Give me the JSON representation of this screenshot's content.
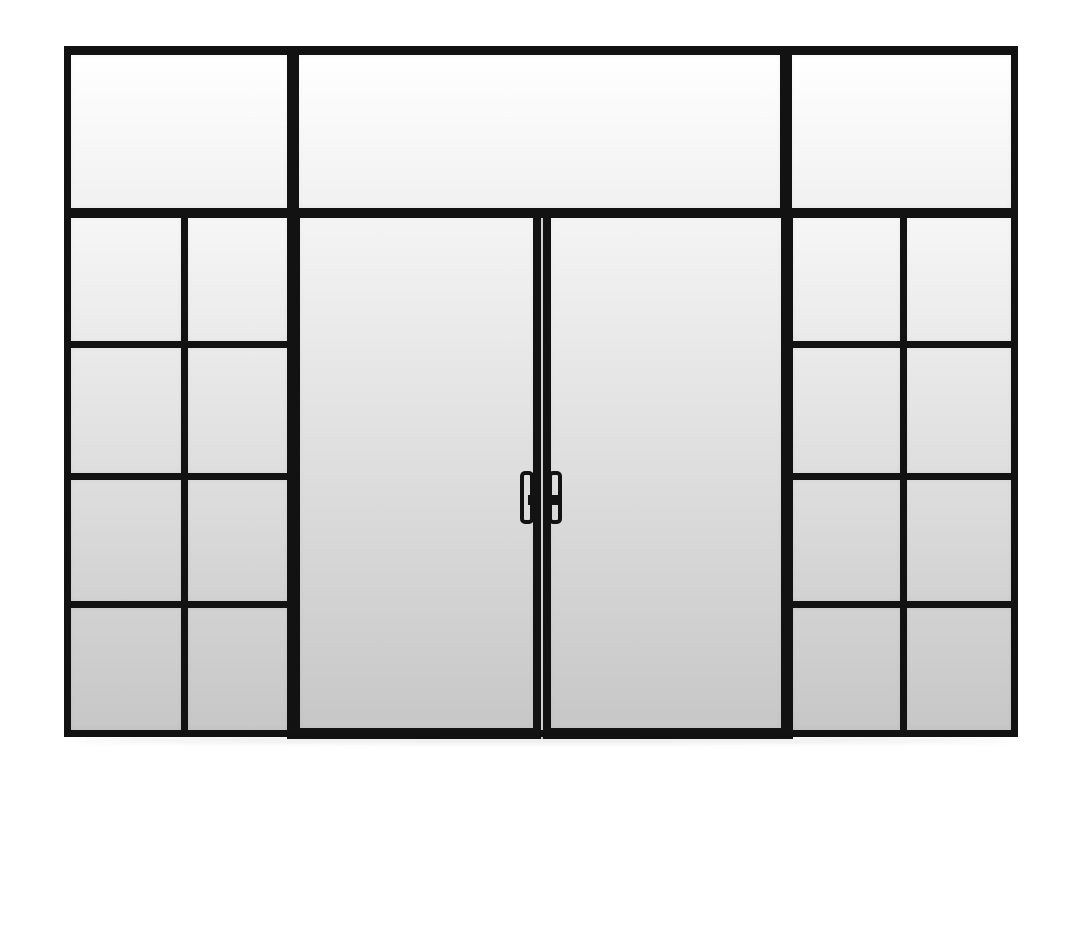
{
  "scene": {
    "description": "Black steel framed glass partition wall with double glass doors, a three-panel transom above, and two four-row grid sidelites, on a white background"
  },
  "colors": {
    "background": "#ffffff",
    "frame": "#121212",
    "meeting_gap": "#cfcfcf",
    "shadow": "rgba(0,0,0,0.09)",
    "transom_glass_gradient": [
      "#ffffff",
      "#f1f1f1"
    ],
    "door_glass_gradient": [
      "#f4f4f4",
      "#c7c7c7"
    ],
    "sidelite_row_gradients": [
      [
        "#f6f6f6",
        "#eaeaea"
      ],
      [
        "#eaeaea",
        "#dedede"
      ],
      [
        "#dedede",
        "#d2d2d2"
      ],
      [
        "#d2d2d2",
        "#c7c7c7"
      ]
    ]
  },
  "structure": {
    "transom": {
      "panels": 3
    },
    "left_sidelite": {
      "columns": 2,
      "rows": 4
    },
    "right_sidelite": {
      "columns": 2,
      "rows": 4
    },
    "doors": {
      "count": 2,
      "handles": 2
    }
  }
}
